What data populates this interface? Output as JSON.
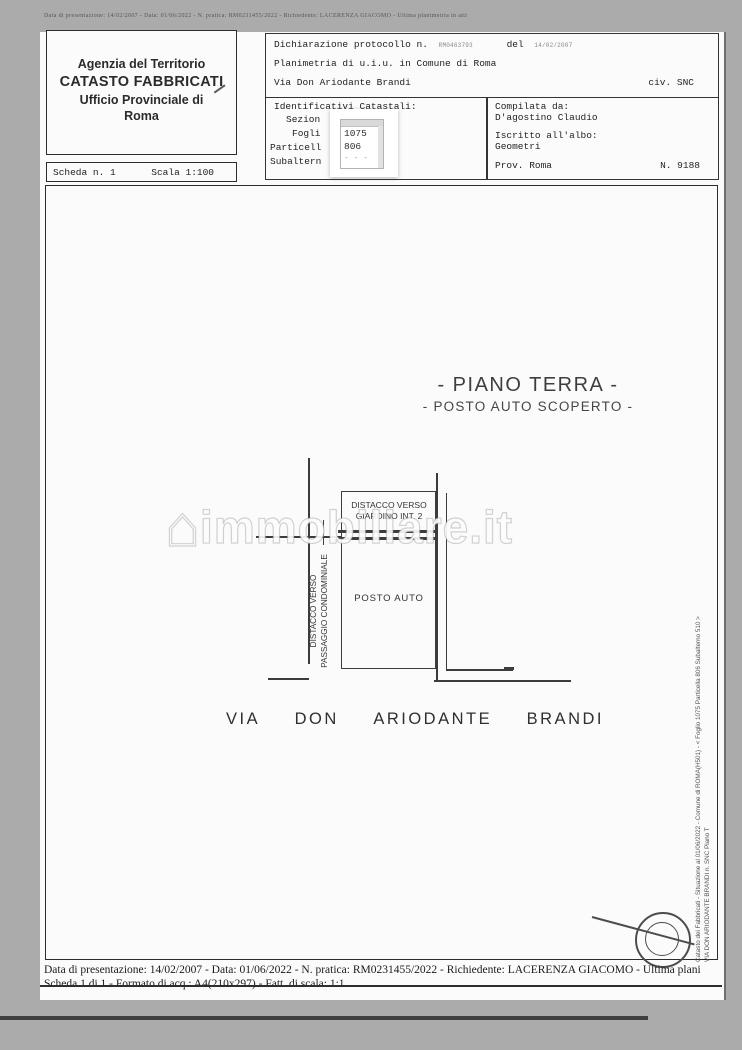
{
  "page": {
    "top_strip": "Data di presentazione: 14/02/2007 - Data: 01/06/2022 - N. pratica: RM0231455/2022 - Richiedente: LACERENZA GIACOMO - Ultima planimetria in atti"
  },
  "agency_box": {
    "line1": "Agenzia del Territorio",
    "line2": "CATASTO FABBRICATI",
    "line3": "Ufficio Provinciale di",
    "line4": "Roma"
  },
  "scheda_box": {
    "scheda": "Scheda n. 1",
    "scala": "Scala 1:100"
  },
  "declaration_box": {
    "protocol_label": "Dichiarazione protocollo n.",
    "protocol_number": "RM0463793",
    "del_label": "del",
    "protocol_date": "14/02/2007",
    "line2": "Planimetria di u.i.u. in Comune di Roma",
    "street": "Via Don Ariodante Brandi",
    "civic": "civ. SNC"
  },
  "identifiers_box": {
    "title": "Identificativi Catastali:",
    "rows": [
      "Sezion",
      "Fogli",
      "Particell",
      "Subaltern"
    ],
    "overlay_values": [
      "1075",
      "806",
      "- - -"
    ]
  },
  "compiler_box": {
    "title": "Compilata da:",
    "name": "D'agostino Claudio",
    "albo_label": "Iscritto all'albo:",
    "albo_value": "Geometri",
    "prov": "Prov. Roma",
    "number": "N. 9188"
  },
  "plan": {
    "title1": "- PIANO TERRA -",
    "title2": "- POSTO AUTO SCOPERTO -",
    "label_giardino_1": "DISTACCO VERSO",
    "label_giardino_2": "GIARDINO INT. 2",
    "label_posto": "POSTO AUTO",
    "label_passaggio_1": "DISTACCO VERSO",
    "label_passaggio_2": "PASSAGGIO CONDOMINIALE",
    "street_words": [
      "VIA",
      "DON",
      "ARIODANTE",
      "BRANDI"
    ],
    "margin_line1": "Catasto dei Fabbricati - Situazione al 01/06/2022 - Comune di ROMA(H501) - < Foglio 1075 Particella 806 Subalterno 510 >",
    "margin_line2": "VIA DON ARIODANTE BRANDI n. SNC Piano T"
  },
  "watermark": {
    "house_icon": "⌂",
    "text": "immobiliare.it"
  },
  "footer": {
    "line1": "Data di presentazione: 14/02/2007 - Data: 01/06/2022 - N. pratica: RM0231455/2022 - Richiedente: LACERENZA GIACOMO - Ultima plani",
    "line2": "Scheda 1 di 1 - Formato di acq.: A4(210x297) - Fatt. di scala: 1:1"
  },
  "colors": {
    "canvas_bg": "#ababab",
    "page_bg": "#fbfbfb",
    "ink": "#2b2b2b",
    "plan_line": "#3c3c3c",
    "watermark": "#c8c8c8"
  }
}
